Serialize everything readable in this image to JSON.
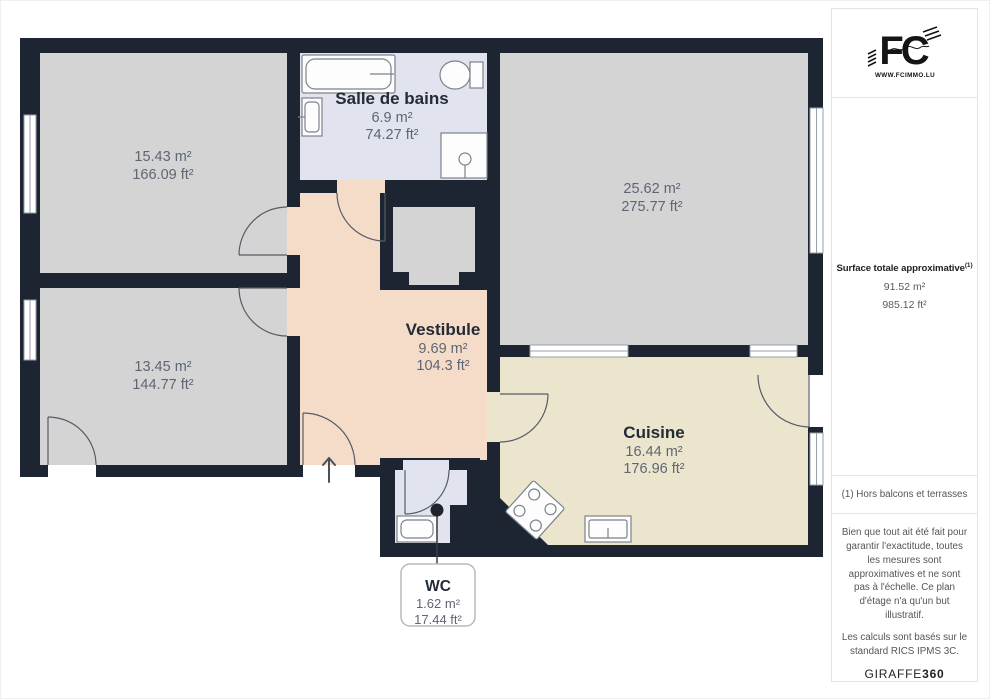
{
  "floorplan": {
    "colors": {
      "wall": "#1c2531",
      "floor_gray": "#d4d4d4",
      "floor_bath": "#e1e4ee",
      "floor_vestibule": "#f5dcc9",
      "floor_kitchen": "#ece5cd",
      "label_name": "#242b38",
      "label_value": "#5e6673"
    },
    "rooms": [
      {
        "id": "bedroom-1",
        "name": "",
        "area_m2": "15.43 m²",
        "area_ft2": "166.09 ft²"
      },
      {
        "id": "salle-de-bains",
        "name": "Salle de bains",
        "area_m2": "6.9 m²",
        "area_ft2": "74.27 ft²"
      },
      {
        "id": "sejour",
        "name": "",
        "area_m2": "25.62 m²",
        "area_ft2": "275.77 ft²"
      },
      {
        "id": "vestibule",
        "name": "Vestibule",
        "area_m2": "9.69 m²",
        "area_ft2": "104.3 ft²"
      },
      {
        "id": "bedroom-2",
        "name": "",
        "area_m2": "13.45 m²",
        "area_ft2": "144.77 ft²"
      },
      {
        "id": "cuisine",
        "name": "Cuisine",
        "area_m2": "16.44 m²",
        "area_ft2": "176.96 ft²"
      },
      {
        "id": "wc",
        "name": "WC",
        "area_m2": "1.62 m²",
        "area_ft2": "17.44 ft²"
      }
    ]
  },
  "sidebar": {
    "logo": {
      "monogram": "FC",
      "website": "WWW.FCIMMO.LU"
    },
    "total": {
      "label": "Surface totale approximative",
      "superscript": "(1)",
      "m2": "91.52 m²",
      "ft2": "985.12 ft²"
    },
    "footnote": "(1) Hors balcons et terrasses",
    "disclaimer": "Bien que tout ait été fait pour garantir l'exactitude, toutes les mesures sont approximatives et ne sont pas à l'échelle. Ce plan d'étage n'a qu'un but illustratif.",
    "standard": "Les calculs sont basés sur le standard RICS IPMS 3C.",
    "brand": {
      "name": "GIRAFFE",
      "suffix": "360"
    }
  }
}
